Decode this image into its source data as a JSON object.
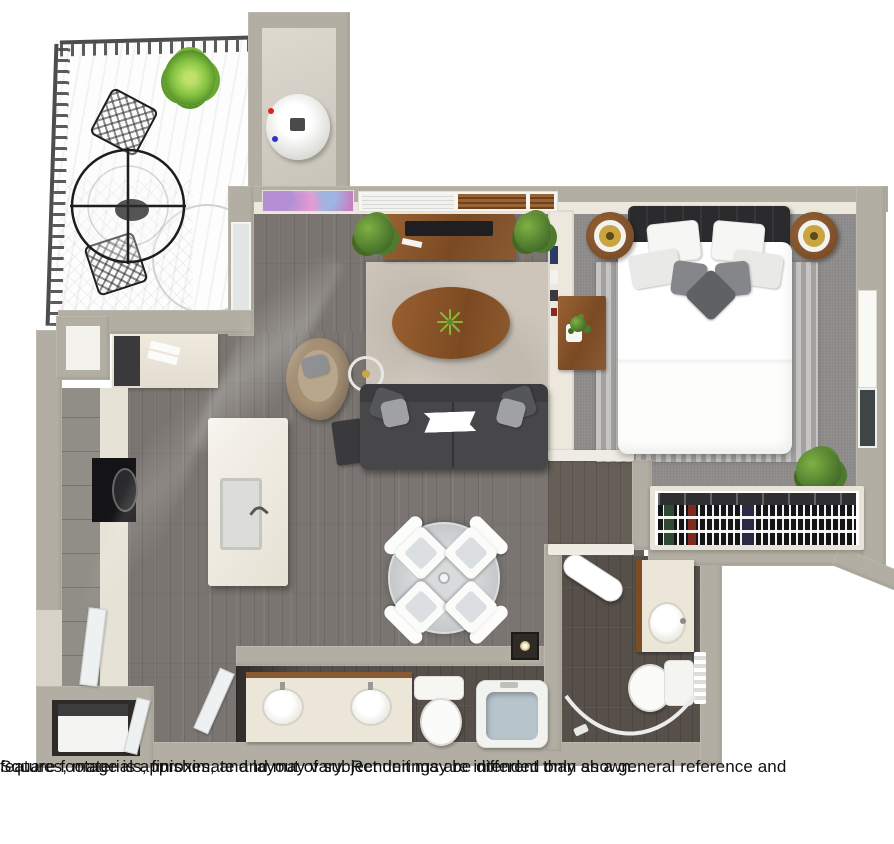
{
  "disclaimer": {
    "text": "Square footage is approximate and may vary. Renderings are intended only as a general reference and features, materials, finishes, and layout of subject unit may be different than shown.",
    "line1": "Square footage is approximate and may vary. Renderings are intended only as a general reference and",
    "line2": "features, materials, finishes, and layout of subject unit may be different than shown."
  },
  "floorplan": {
    "type": "3d-floorplan-rendering",
    "unit": "one-bedroom apartment with balcony",
    "rooms": [
      "balcony",
      "utility-closet",
      "kitchen",
      "living-room",
      "dining-area",
      "bedroom",
      "closet",
      "bathroom",
      "ensuite-bathroom",
      "laundry-closet"
    ]
  },
  "colors": {
    "wall": "#b2aea3",
    "wallFace": "#ece8dd",
    "wood": "#7a7571",
    "carpet": "#8e8d8b",
    "bathFloor": "#57504a",
    "rug": "#cdc5b9",
    "sofa": "#47474a",
    "furnitureWood": "#8a5a33",
    "accent": "#a59076",
    "tub": "#b8c4cc",
    "greenery": "#4e7a2e",
    "textColor": "#111111",
    "background": "#ffffff"
  }
}
